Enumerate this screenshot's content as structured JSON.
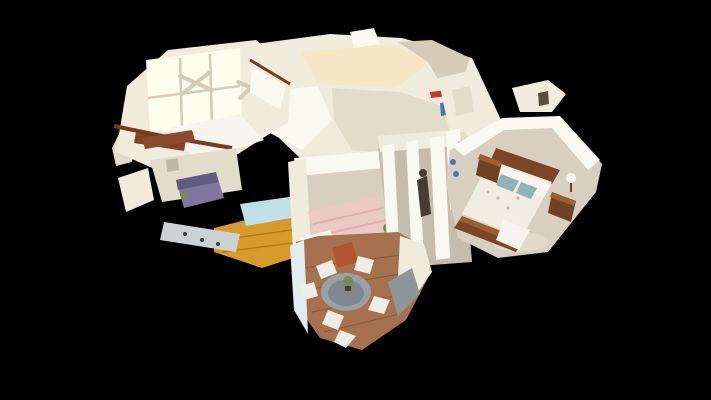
{
  "canvas": {
    "width": 711,
    "height": 400,
    "view": "dollhouse",
    "background": "#000000"
  },
  "scene": {
    "description": "3D cutaway dollhouse view of a single-story home interior rendered on a black background",
    "palette": {
      "background": "#000000",
      "wall_bright": "#fbf8f0",
      "wall_light": "#f1ebdd",
      "wall_mid": "#e4dcca",
      "wall_dim": "#d5cbb6",
      "wall_shadow": "#c2b8a1",
      "ceiling_warm": "#f5e7c6",
      "glow": "#fffdee",
      "carpet": "#d8cfc2",
      "carpet_dark": "#c6bcad",
      "wood_amber": "#d79a2f",
      "wood_amber_dark": "#b57c15",
      "wood_nook": "#a5714e",
      "wood_nook_dark": "#86583a",
      "bed_pink": "#ebc9c5",
      "bed_pink_dark": "#ddb1ae",
      "bed_wood": "#7b4526",
      "bed_wood_light": "#9c5e33",
      "mattress": "#f1ede3",
      "pillow_teal": "#8eb4b6",
      "pillow_white": "#f8f5ee",
      "nightstand_wood": "#6f4226",
      "sofa_purple": "#8077a0",
      "sofa_purple_dark": "#615a84",
      "table_blue": "#bfe0e9",
      "table_gray": "#9ba0a5",
      "table_gray_dark": "#80878d",
      "chair_white": "#f0ede5",
      "railing": "#7a3a20",
      "roof_brown": "#8a4a2e",
      "counter_gray": "#ccd2d4",
      "accent_red": "#c13a2c",
      "accent_blue": "#4079b3",
      "accent_rust": "#b0552f",
      "figure": "#463c33",
      "plant": "#6f8f58",
      "glass_wall": "#e3ecef",
      "gray_wall": "#8f969b",
      "rug_light": "#e4dccf",
      "door_dark": "#57503f"
    },
    "regions": [
      {
        "id": "loft-bedroom",
        "note": "white room with tall grid windows, ceiling fans, dark stair railing"
      },
      {
        "id": "living-area",
        "note": "purple sofa, light blue table, amber wood floor, gray counter"
      },
      {
        "id": "center-bedroom",
        "note": "pink striped bed on beige carpet"
      },
      {
        "id": "hallway",
        "note": "white columns, standing figure, wood dresser"
      },
      {
        "id": "master-bedroom",
        "note": "wood sleigh bed, white dotted bedding, teal pillows, nightstands, lamp"
      },
      {
        "id": "breakfast-nook",
        "note": "octagonal bay nook, round gray table, white chairs, plank floor"
      }
    ]
  }
}
